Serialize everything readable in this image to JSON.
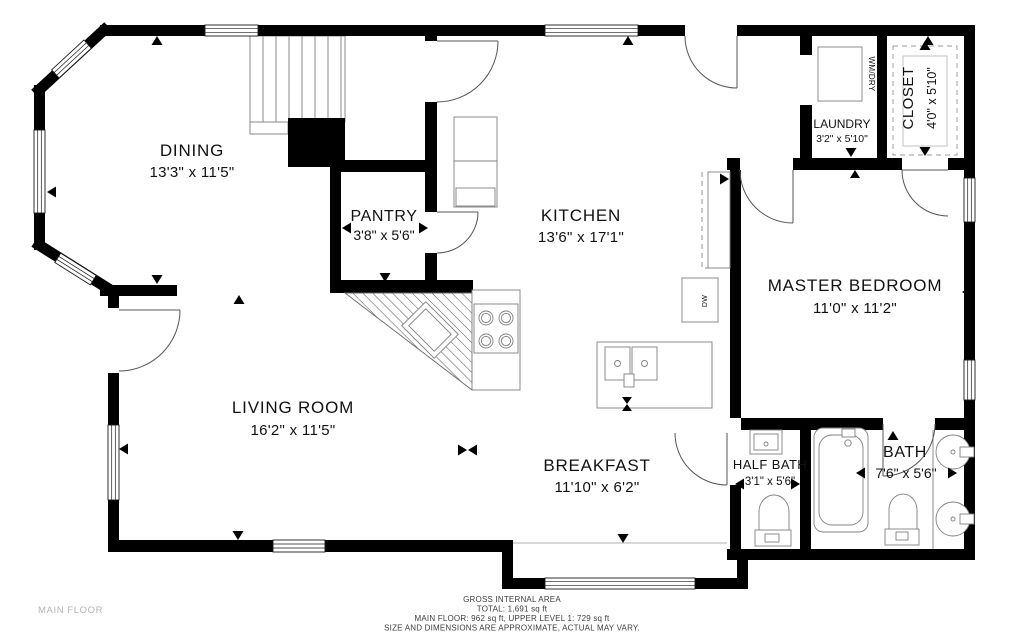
{
  "rooms": {
    "dining": {
      "name": "DINING",
      "dims": "13'3\" x 11'5\""
    },
    "pantry": {
      "name": "PANTRY",
      "dims": "3'8\" x 5'6\""
    },
    "kitchen": {
      "name": "KITCHEN",
      "dims": "13'6\" x 17'1\""
    },
    "living_room": {
      "name": "LIVING ROOM",
      "dims": "16'2\" x 11'5\""
    },
    "breakfast": {
      "name": "BREAKFAST",
      "dims": "11'10\" x 6'2\""
    },
    "master_bedroom": {
      "name": "MASTER BEDROOM",
      "dims": "11'0\" x 11'2\""
    },
    "laundry": {
      "name": "LAUNDRY",
      "dims": "3'2\" x 5'10\""
    },
    "closet": {
      "name": "CLOSET",
      "dims": "4'0\" x 5'10\""
    },
    "half_bath": {
      "name": "HALF BATH",
      "dims": "3'1\" x 5'6\""
    },
    "bath": {
      "name": "BATH",
      "dims": "7'6\" x 5'6\""
    }
  },
  "appliances": {
    "washer_dryer": "WM/DRY",
    "dishwasher": "DW"
  },
  "footer": {
    "floor_label": "MAIN FLOOR",
    "area_title": "GROSS INTERNAL AREA",
    "area_total": "TOTAL: 1,691 sq ft",
    "area_breakdown": "MAIN FLOOR: 962 sq ft, UPPER LEVEL 1: 729 sq ft",
    "disclaimer": "SIZE AND DIMENSIONS ARE APPROXIMATE, ACTUAL MAY VARY."
  },
  "colors": {
    "wall": "#000000",
    "fixture_line": "#808080",
    "background": "#ffffff",
    "footer_text": "#3c3c3c",
    "floor_label_text": "#b3b3b3"
  }
}
